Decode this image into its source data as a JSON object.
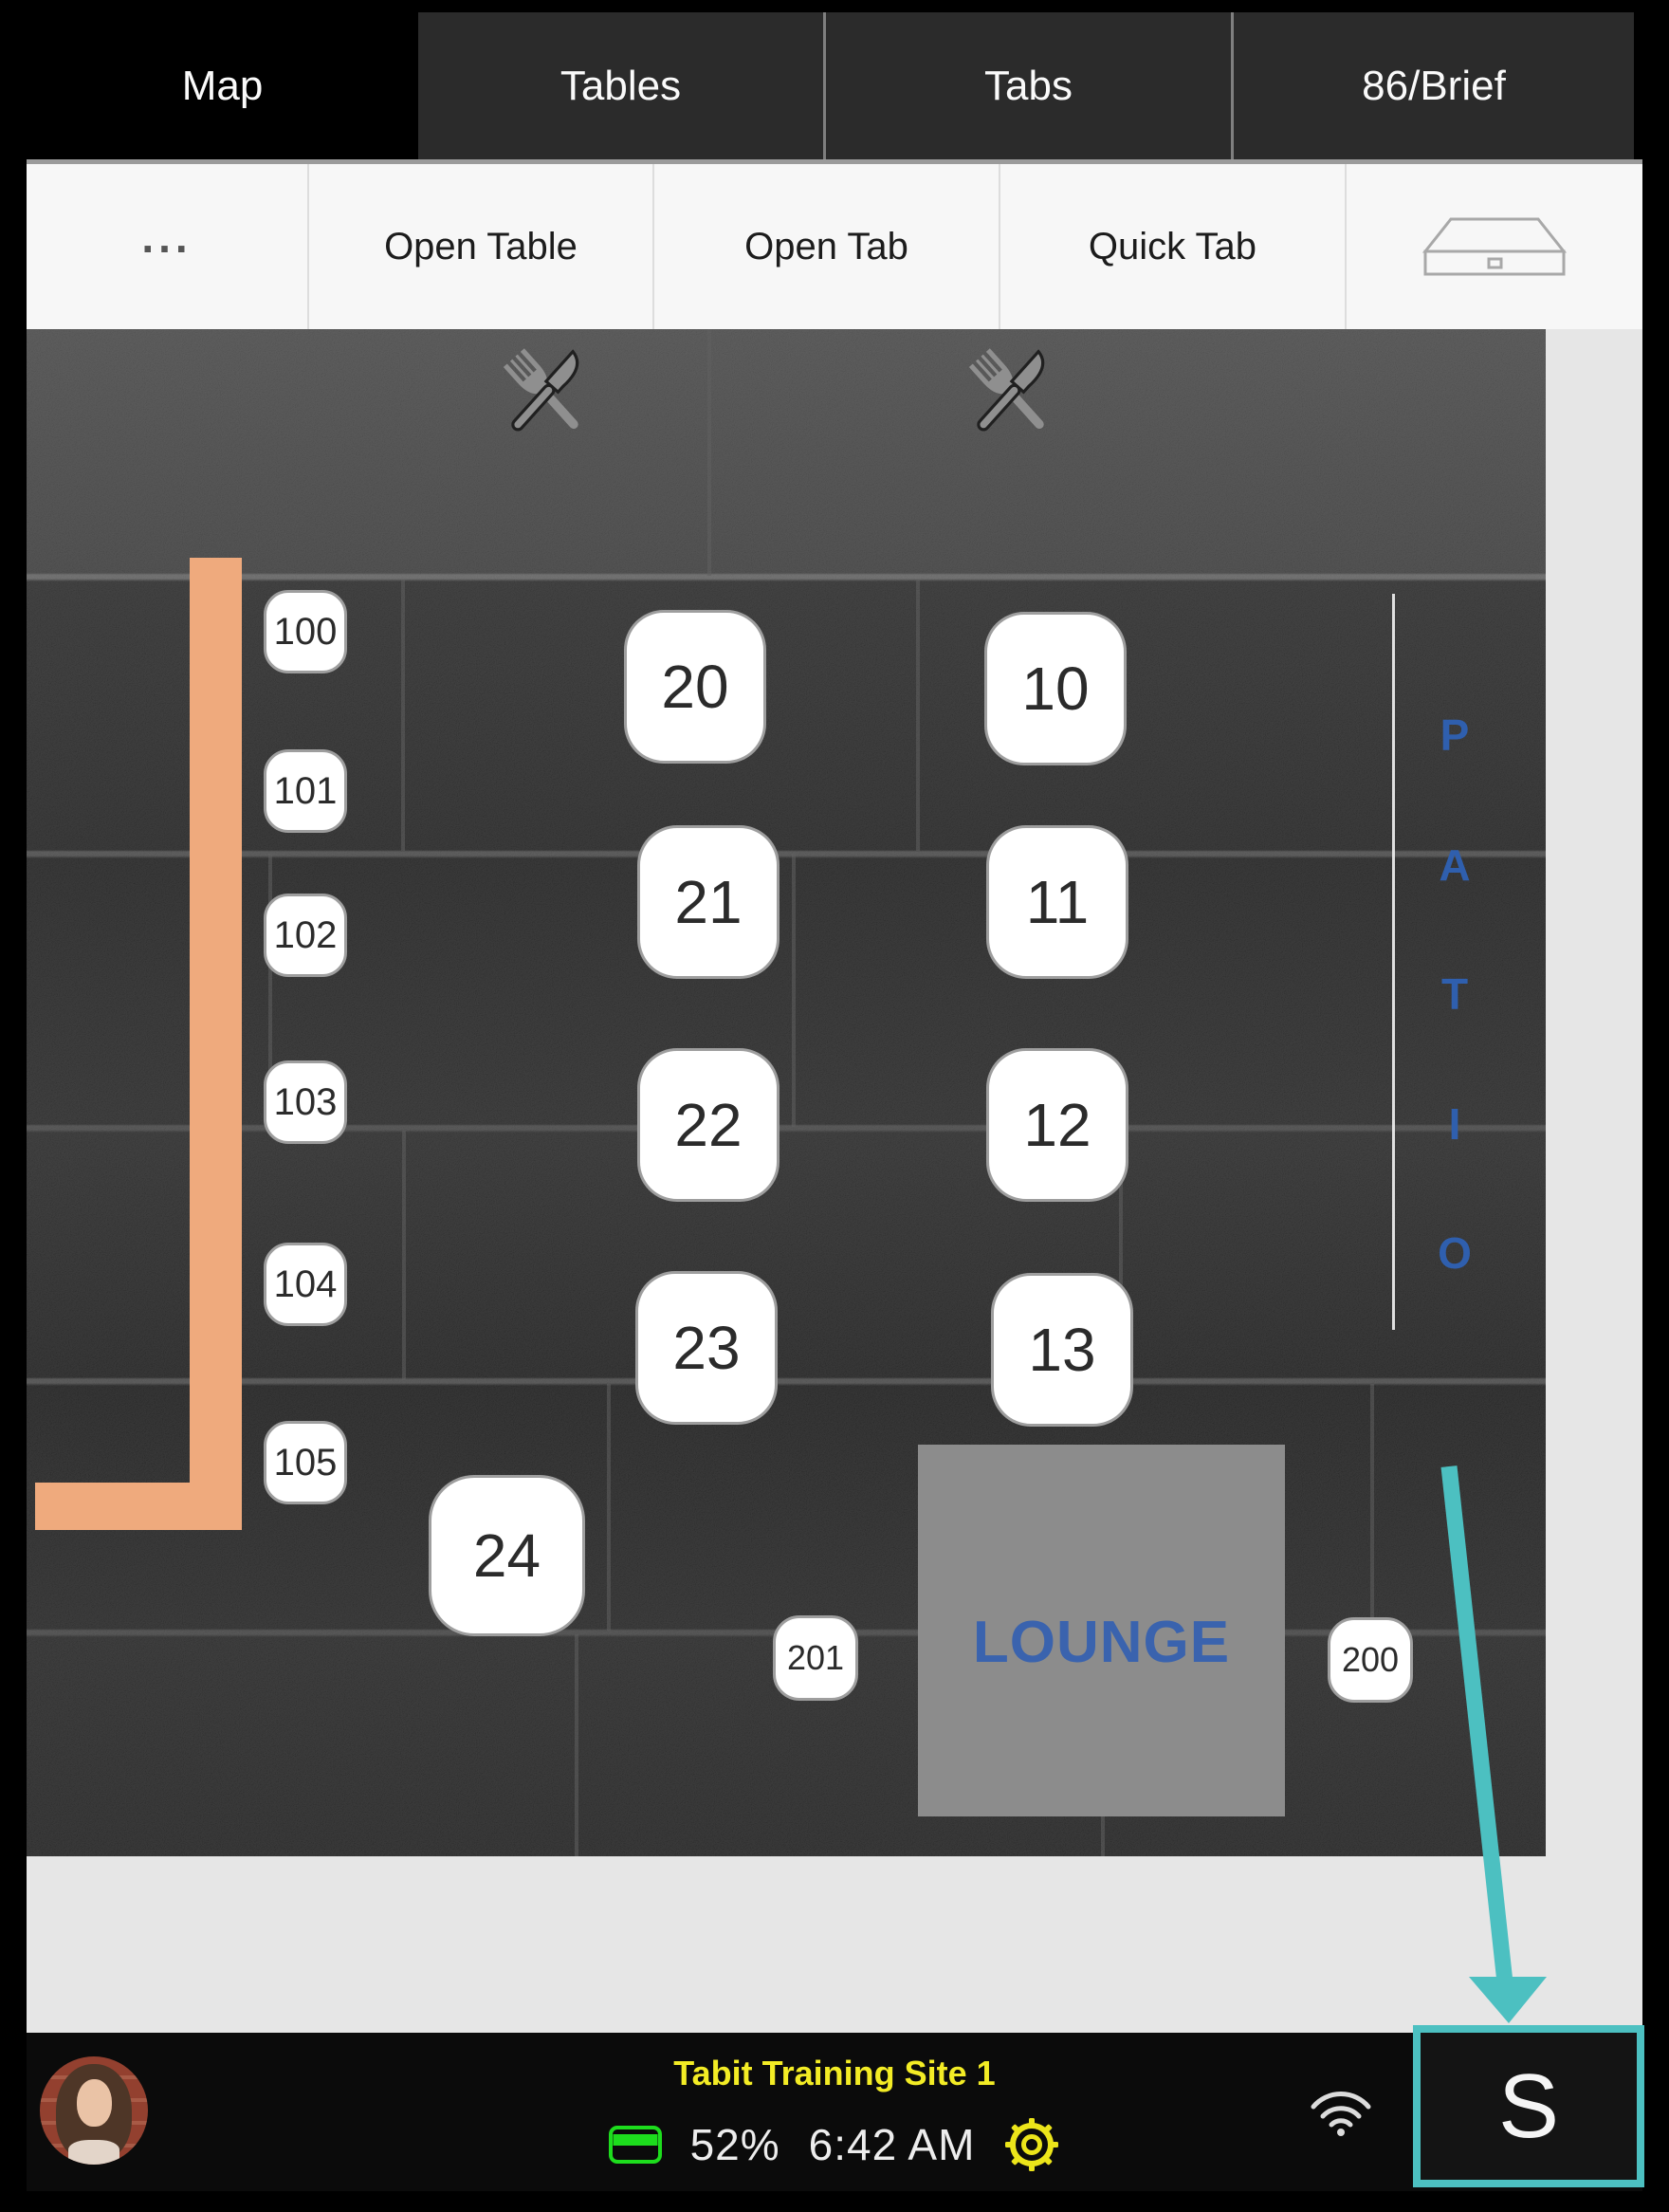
{
  "nav": {
    "tabs": [
      {
        "label": "Map",
        "active": true
      },
      {
        "label": "Tables",
        "active": false
      },
      {
        "label": "Tabs",
        "active": false
      },
      {
        "label": "86/Brief",
        "active": false
      }
    ]
  },
  "toolbar": {
    "more": "...",
    "open_table": "Open Table",
    "open_tab": "Open Tab",
    "quick_tab": "Quick Tab",
    "drawer_icon": "cash-drawer-icon"
  },
  "map": {
    "decor_icons": [
      "fork-knife-icon",
      "fork-knife-icon"
    ],
    "patio": {
      "letters": [
        "P",
        "A",
        "T",
        "I",
        "O"
      ]
    },
    "lounge": {
      "label": "LOUNGE"
    },
    "tables": [
      "100",
      "101",
      "102",
      "103",
      "104",
      "105",
      "20",
      "21",
      "22",
      "23",
      "24",
      "10",
      "11",
      "12",
      "13",
      "201",
      "200"
    ]
  },
  "status_bar": {
    "site_name": "Tabit Training Site 1",
    "battery_percent": "52%",
    "time": "6:42 AM",
    "server_button": "S",
    "icons": {
      "battery": "battery-icon",
      "settings": "gear-icon",
      "wifi": "wifi-icon",
      "avatar": "user-avatar"
    }
  },
  "colors": {
    "accent_teal": "#4CC0C1",
    "site_name_yellow": "#F3EC25",
    "wall_orange": "#EFAA7D",
    "zone_blue": "#3A63AE",
    "battery_green": "#1DDD1D"
  }
}
